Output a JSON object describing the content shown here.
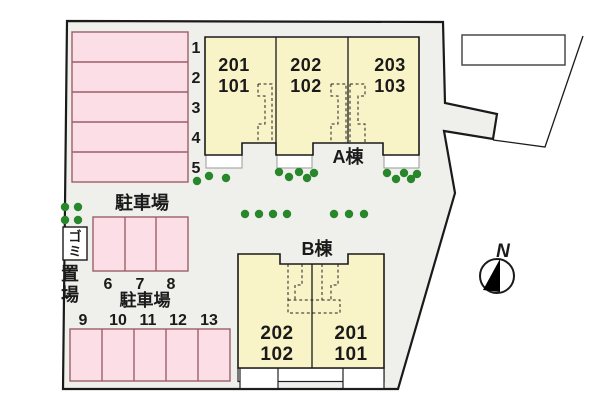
{
  "plan": {
    "building_a": {
      "label": "A棟",
      "units": [
        {
          "top": "201",
          "bottom": "101"
        },
        {
          "top": "202",
          "bottom": "102"
        },
        {
          "top": "203",
          "bottom": "103"
        }
      ]
    },
    "building_b": {
      "label": "B棟",
      "units": [
        {
          "top": "202",
          "bottom": "102"
        },
        {
          "top": "201",
          "bottom": "101"
        }
      ]
    },
    "parking_lot_upper": {
      "label": "駐車場",
      "spaces": [
        "1",
        "2",
        "3",
        "4",
        "5"
      ]
    },
    "parking_lot_middle": {
      "label": "駐車場",
      "spaces": [
        "6",
        "7",
        "8"
      ]
    },
    "parking_lot_lower": {
      "spaces": [
        "9",
        "10",
        "11",
        "12",
        "13"
      ]
    },
    "garbage_area": {
      "label": "ゴミ置場",
      "box_chars": [
        "ゴ",
        "ミ"
      ],
      "below_chars": [
        "置",
        "場"
      ]
    },
    "compass": {
      "label": "N"
    },
    "colors": {
      "site_fill": "#efefec",
      "building_fill": "#f9f4c8",
      "parking_fill": "#fcdfe6",
      "parking_stroke": "#9c5f68",
      "tree_green": "#27872a",
      "line": "#1a1a1a"
    }
  }
}
